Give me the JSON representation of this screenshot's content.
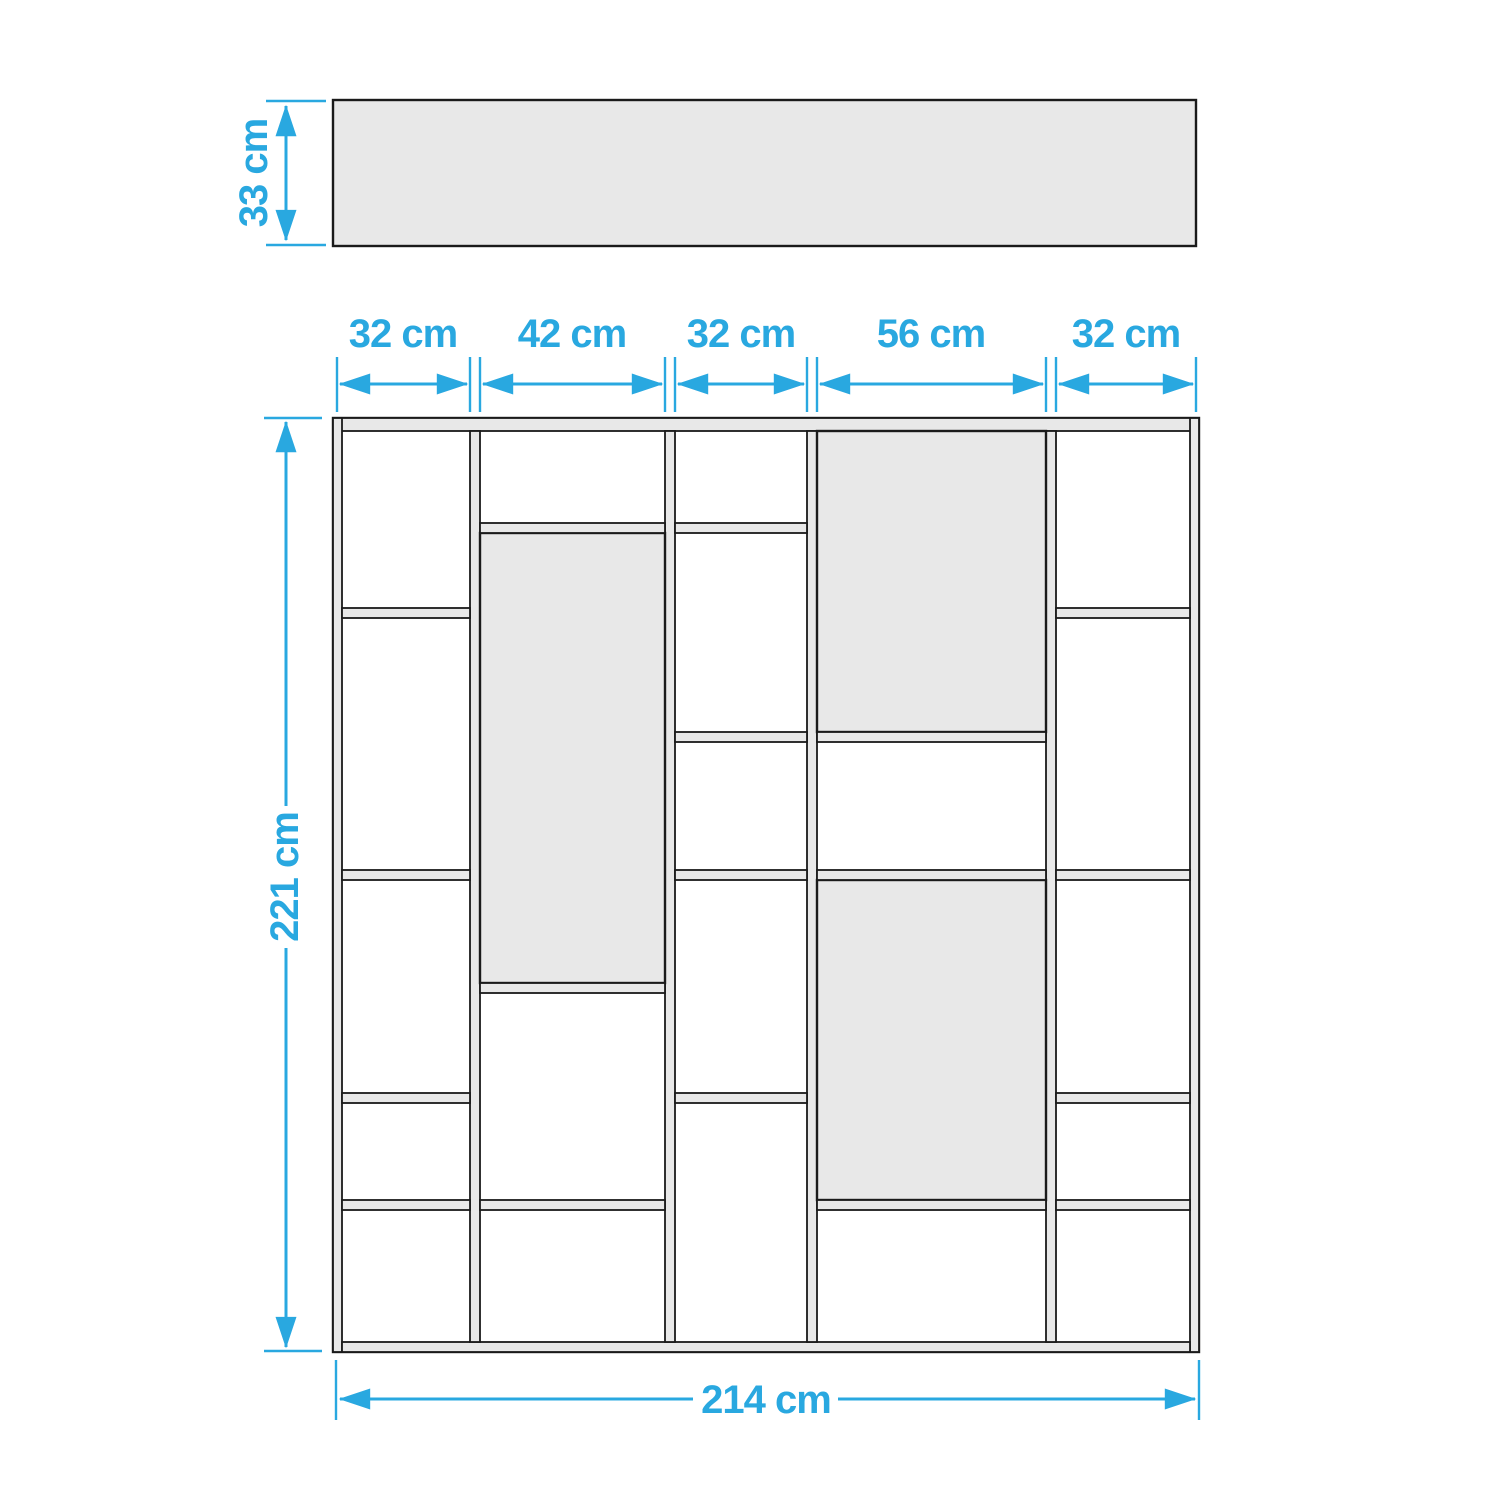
{
  "colors": {
    "dimension": "#29a8e0",
    "outline": "#1a1a1a",
    "panel": "#e8e8e8",
    "background": "#ffffff"
  },
  "top_view": {
    "depth_label": "33 cm"
  },
  "front_view": {
    "height_label": "221 cm",
    "width_label": "214 cm",
    "column_width_labels": [
      "32 cm",
      "42 cm",
      "32 cm",
      "56 cm",
      "32 cm"
    ]
  }
}
